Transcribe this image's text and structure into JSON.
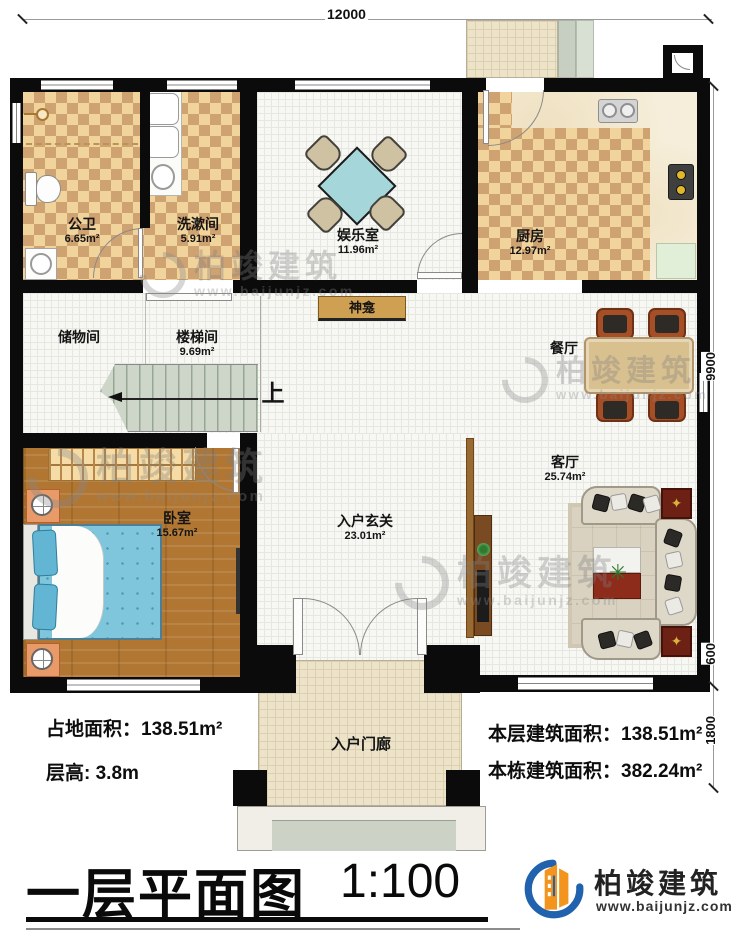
{
  "dimensions": {
    "top_width": "12000",
    "right_main": "9900",
    "right_step": "600",
    "right_porch": "1800"
  },
  "rooms": {
    "bathroom": {
      "name": "公卫",
      "area": "6.65m²"
    },
    "washroom": {
      "name": "洗漱间",
      "area": "5.91m²"
    },
    "entertainment": {
      "name": "娱乐室",
      "area": "11.96m²"
    },
    "kitchen": {
      "name": "厨房",
      "area": "12.97m²"
    },
    "shrine": {
      "name": "神龛"
    },
    "storage": {
      "name": "储物间"
    },
    "stairwell": {
      "name": "楼梯间",
      "area": "9.69m²"
    },
    "dining": {
      "name": "餐厅"
    },
    "living": {
      "name": "客厅",
      "area": "25.74m²"
    },
    "bedroom": {
      "name": "卧室",
      "area": "15.67m²"
    },
    "foyer": {
      "name": "入户玄关",
      "area": "23.01m²"
    },
    "porch": {
      "name": "入户门廊"
    },
    "stairs_up": "上"
  },
  "stats": {
    "footprint": "占地面积：138.51m²",
    "floor_height": "层高: 3.8m",
    "floor_area": "本层建筑面积：138.51m²",
    "total_area": "本栋建筑面积：382.24m²"
  },
  "title": {
    "text": "一层平面图",
    "scale": "1:100"
  },
  "brand": {
    "name": "柏竣建筑",
    "url": "www.baijunjz.com"
  },
  "watermark": {
    "name": "柏竣建筑",
    "url": "www.baijunjz.com"
  },
  "colors": {
    "brand_blue": "#2062ae",
    "brand_orange": "#f2941d"
  }
}
